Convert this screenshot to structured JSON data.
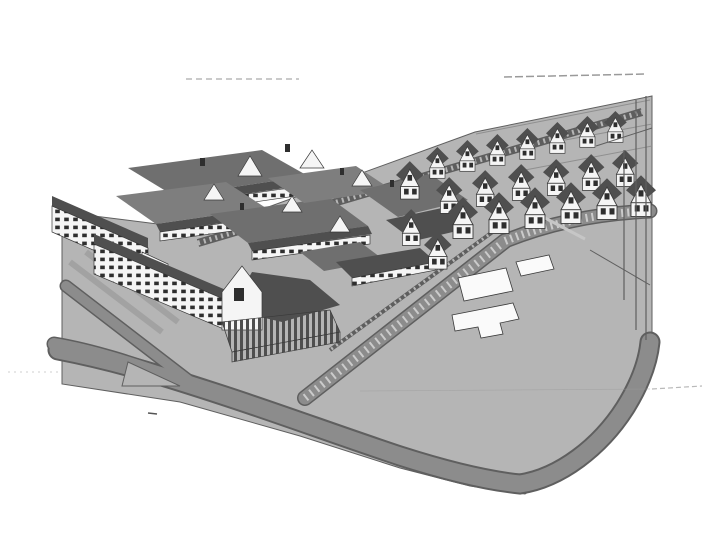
{
  "colors": {
    "paper": "#ffffff",
    "ground": "#b5b5b5",
    "road": "#8c8c8c",
    "road-edge": "#5f5f5f",
    "track": "#5e5e5e",
    "roof": "#6f6f6f",
    "roof-mid": "#7e7e7e",
    "roof-dark": "#4f4f4f",
    "wall": "#f5f5f5",
    "window": "#2e2e2e",
    "pitch": "#fafafa",
    "line": "#3a3a3a",
    "faint": "#b9b9b9"
  }
}
